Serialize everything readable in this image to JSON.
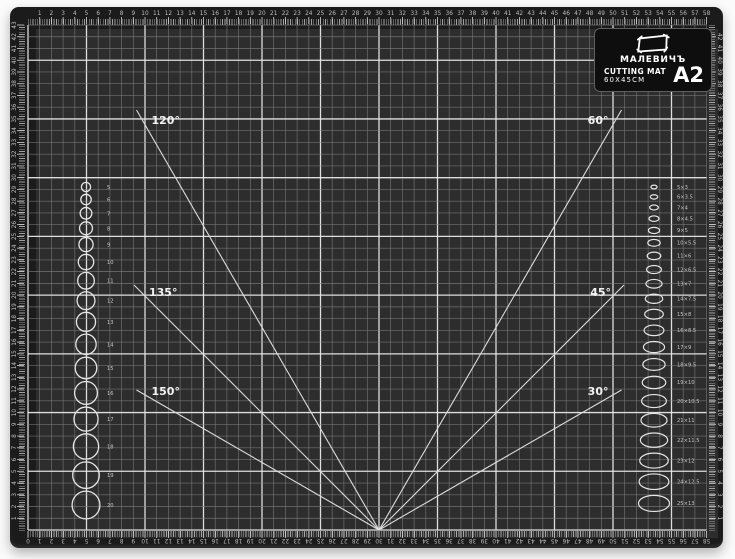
{
  "scene": {
    "description": "product photo of a black self-healing cutting mat on white background",
    "background_color": "#fbfbfb"
  },
  "mat": {
    "colors": {
      "mat_body": "#1b1b1b",
      "surface": "#2d2d2d",
      "grid_minor": "#828282",
      "grid_major": "#e8e8e8",
      "marking": "#e6e6e6",
      "label_text": "#c6c6c6",
      "angle_text": "#f2f2f2",
      "plate_bg": "#0e0e0e"
    },
    "brand_plate": {
      "logo_icon": "rectangle-outline-icon",
      "brand": "МАЛЕВИЧЪ",
      "product": "CUTTING MAT",
      "dimensions": "60X45CM",
      "format": "A2"
    },
    "angle_guides": [
      {
        "label": "120°",
        "degrees": 120
      },
      {
        "label": "135°",
        "degrees": 135
      },
      {
        "label": "150°",
        "degrees": 150
      },
      {
        "label": "60°",
        "degrees": 60
      },
      {
        "label": "45°",
        "degrees": 45
      },
      {
        "label": "30°",
        "degrees": 30
      }
    ],
    "circle_column": {
      "side": "left",
      "labels": [
        "5",
        "6",
        "7",
        "8",
        "9",
        "10",
        "11",
        "12",
        "13",
        "14",
        "15",
        "16",
        "17",
        "18",
        "19",
        "20"
      ]
    },
    "ellipse_column": {
      "side": "right",
      "labels": [
        "5×3",
        "6×3.5",
        "7×4",
        "8×4.5",
        "9×5",
        "10×5.5",
        "11×6",
        "12×6.5",
        "13×7",
        "14×7.5",
        "15×8",
        "16×8.5",
        "17×9",
        "18×9.5",
        "19×10",
        "20×10.5",
        "21×11",
        "22×11.5",
        "23×12",
        "24×12.5",
        "25×13"
      ]
    },
    "rulers": {
      "unit": "cm",
      "top": {
        "start": 1,
        "end": 58
      },
      "bottom": {
        "start": 0,
        "end": 58
      },
      "left": {
        "start": 43,
        "end": 1
      },
      "right": {
        "start": 42,
        "end": 1
      }
    }
  }
}
